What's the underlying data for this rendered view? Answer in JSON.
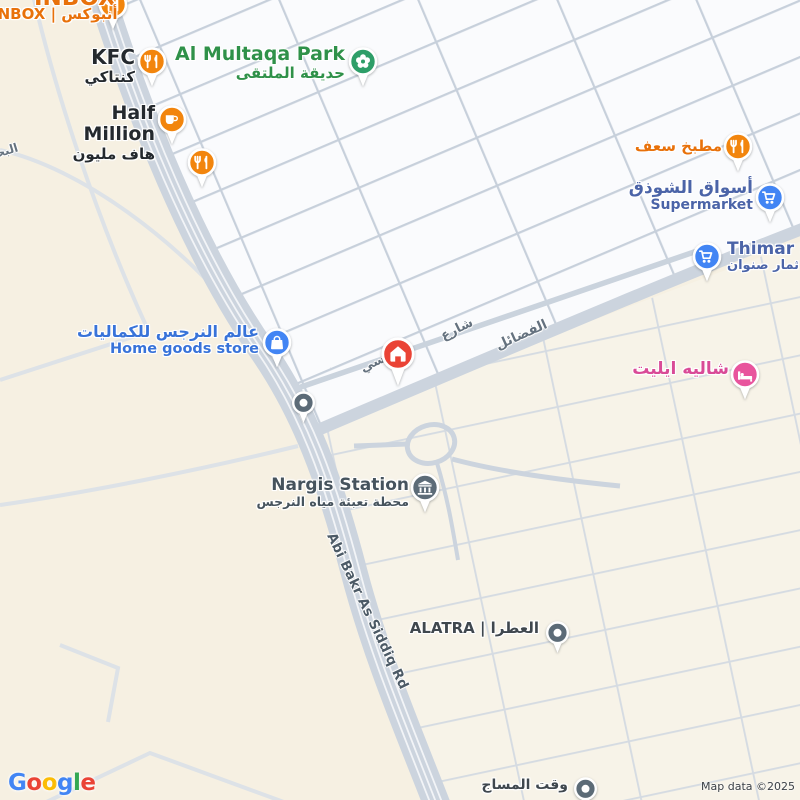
{
  "pois": {
    "inbox": {
      "title": "INBOX",
      "subtitle": "INBOX | أنبوكس",
      "icon": "restaurant-icon"
    },
    "kfc": {
      "title": "KFC",
      "subtitle": "كنتاكي",
      "icon": "restaurant-icon"
    },
    "al_multaqa_park": {
      "title": "Al Multaqa Park",
      "subtitle": "حديقة الملتقى",
      "icon": "park-flower-icon"
    },
    "half_million": {
      "title": "Half Million",
      "subtitle": "هاف مليون",
      "icon": "cafe-cup-icon"
    },
    "unnamed_restaurant": {
      "icon": "restaurant-icon"
    },
    "matbakh_saaf": {
      "title": "مطبخ سعف",
      "icon": "restaurant-icon"
    },
    "aswaq_alshawthaq": {
      "title": "أسواق الشوذق",
      "subtitle": "Supermarket",
      "icon": "shopping-cart-icon"
    },
    "thimar": {
      "title": "Thimar Se",
      "subtitle": "ثمار صنوان",
      "icon": "shopping-cart-icon"
    },
    "alam_alnarjis": {
      "title": "عالم النرجس للكماليات",
      "subtitle": "Home goods store",
      "icon": "shopping-bag-icon"
    },
    "destination_marker": {
      "icon": "house-icon"
    },
    "unnamed_place": {
      "icon": "dot-icon"
    },
    "chalet_elite": {
      "title": "شاليه ايليت",
      "icon": "bed-icon"
    },
    "nargis_station": {
      "title": "Nargis Station",
      "subtitle": "محطة تعبئة مياه النرجس",
      "icon": "water-station-icon"
    },
    "alatra": {
      "title": "ALATRA | العطرا",
      "icon": "dot-icon"
    },
    "waqt_almassage": {
      "title": "وقت المساج",
      "icon": "dot-icon"
    }
  },
  "streets": {
    "abi_bakr": "Abi Bakr As Siddiq Rd",
    "al_fadail": "الفضائل",
    "sharee": "شارع",
    "sharee_end": "سي",
    "al_bahr": "البحـ"
  },
  "attribution": {
    "logo_letters": [
      "G",
      "o",
      "o",
      "g",
      "l",
      "e"
    ],
    "map_data": "Map data ©2025"
  },
  "colors": {
    "background_cream": "#f6f0e2",
    "blocks_white": "#fafbfd",
    "road_gray": "#ccd4de",
    "marker_red": "#EA4335",
    "pin_orange": "#F2850D",
    "pin_blue": "#4285F4",
    "pin_green": "#2E9E68",
    "pin_pink": "#E8549D",
    "pin_slate": "#5C6B77",
    "label_orange": "#E8710A",
    "label_green": "#2F9149",
    "label_shopping_blue": "#4B64A8",
    "label_store_blue": "#3873D9",
    "label_pink": "#D94A97"
  }
}
